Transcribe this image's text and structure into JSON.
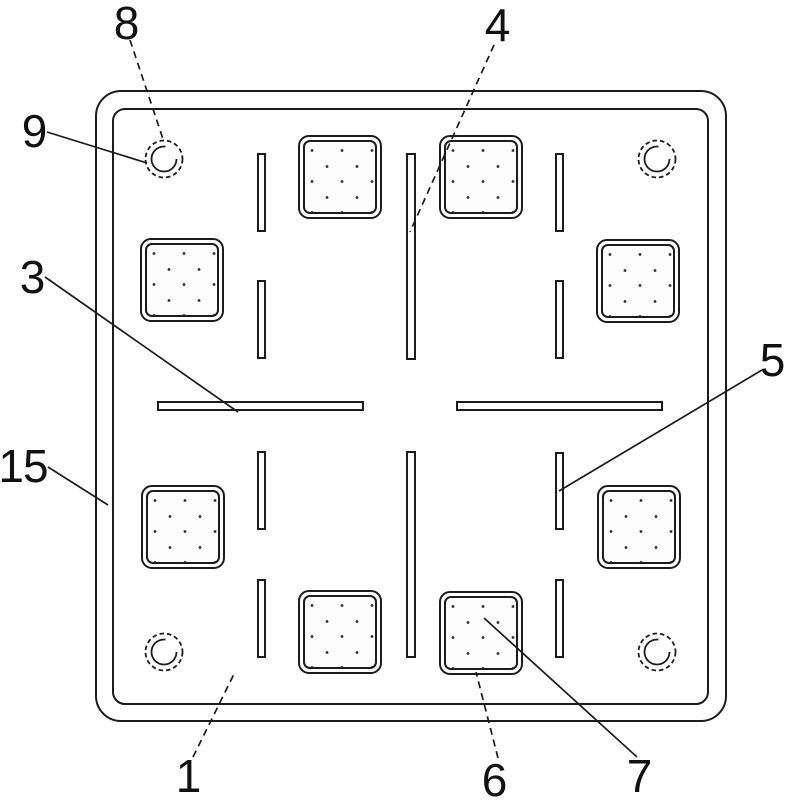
{
  "figure": {
    "colors": {
      "background": "#ffffff",
      "line": "#1c1c1c",
      "label_text": "#111111"
    },
    "reference_labels": {
      "n1": "1",
      "n3": "3",
      "n4": "4",
      "n5": "5",
      "n6": "6",
      "n7": "7",
      "n8": "8",
      "n9": "9",
      "n15": "15"
    }
  }
}
